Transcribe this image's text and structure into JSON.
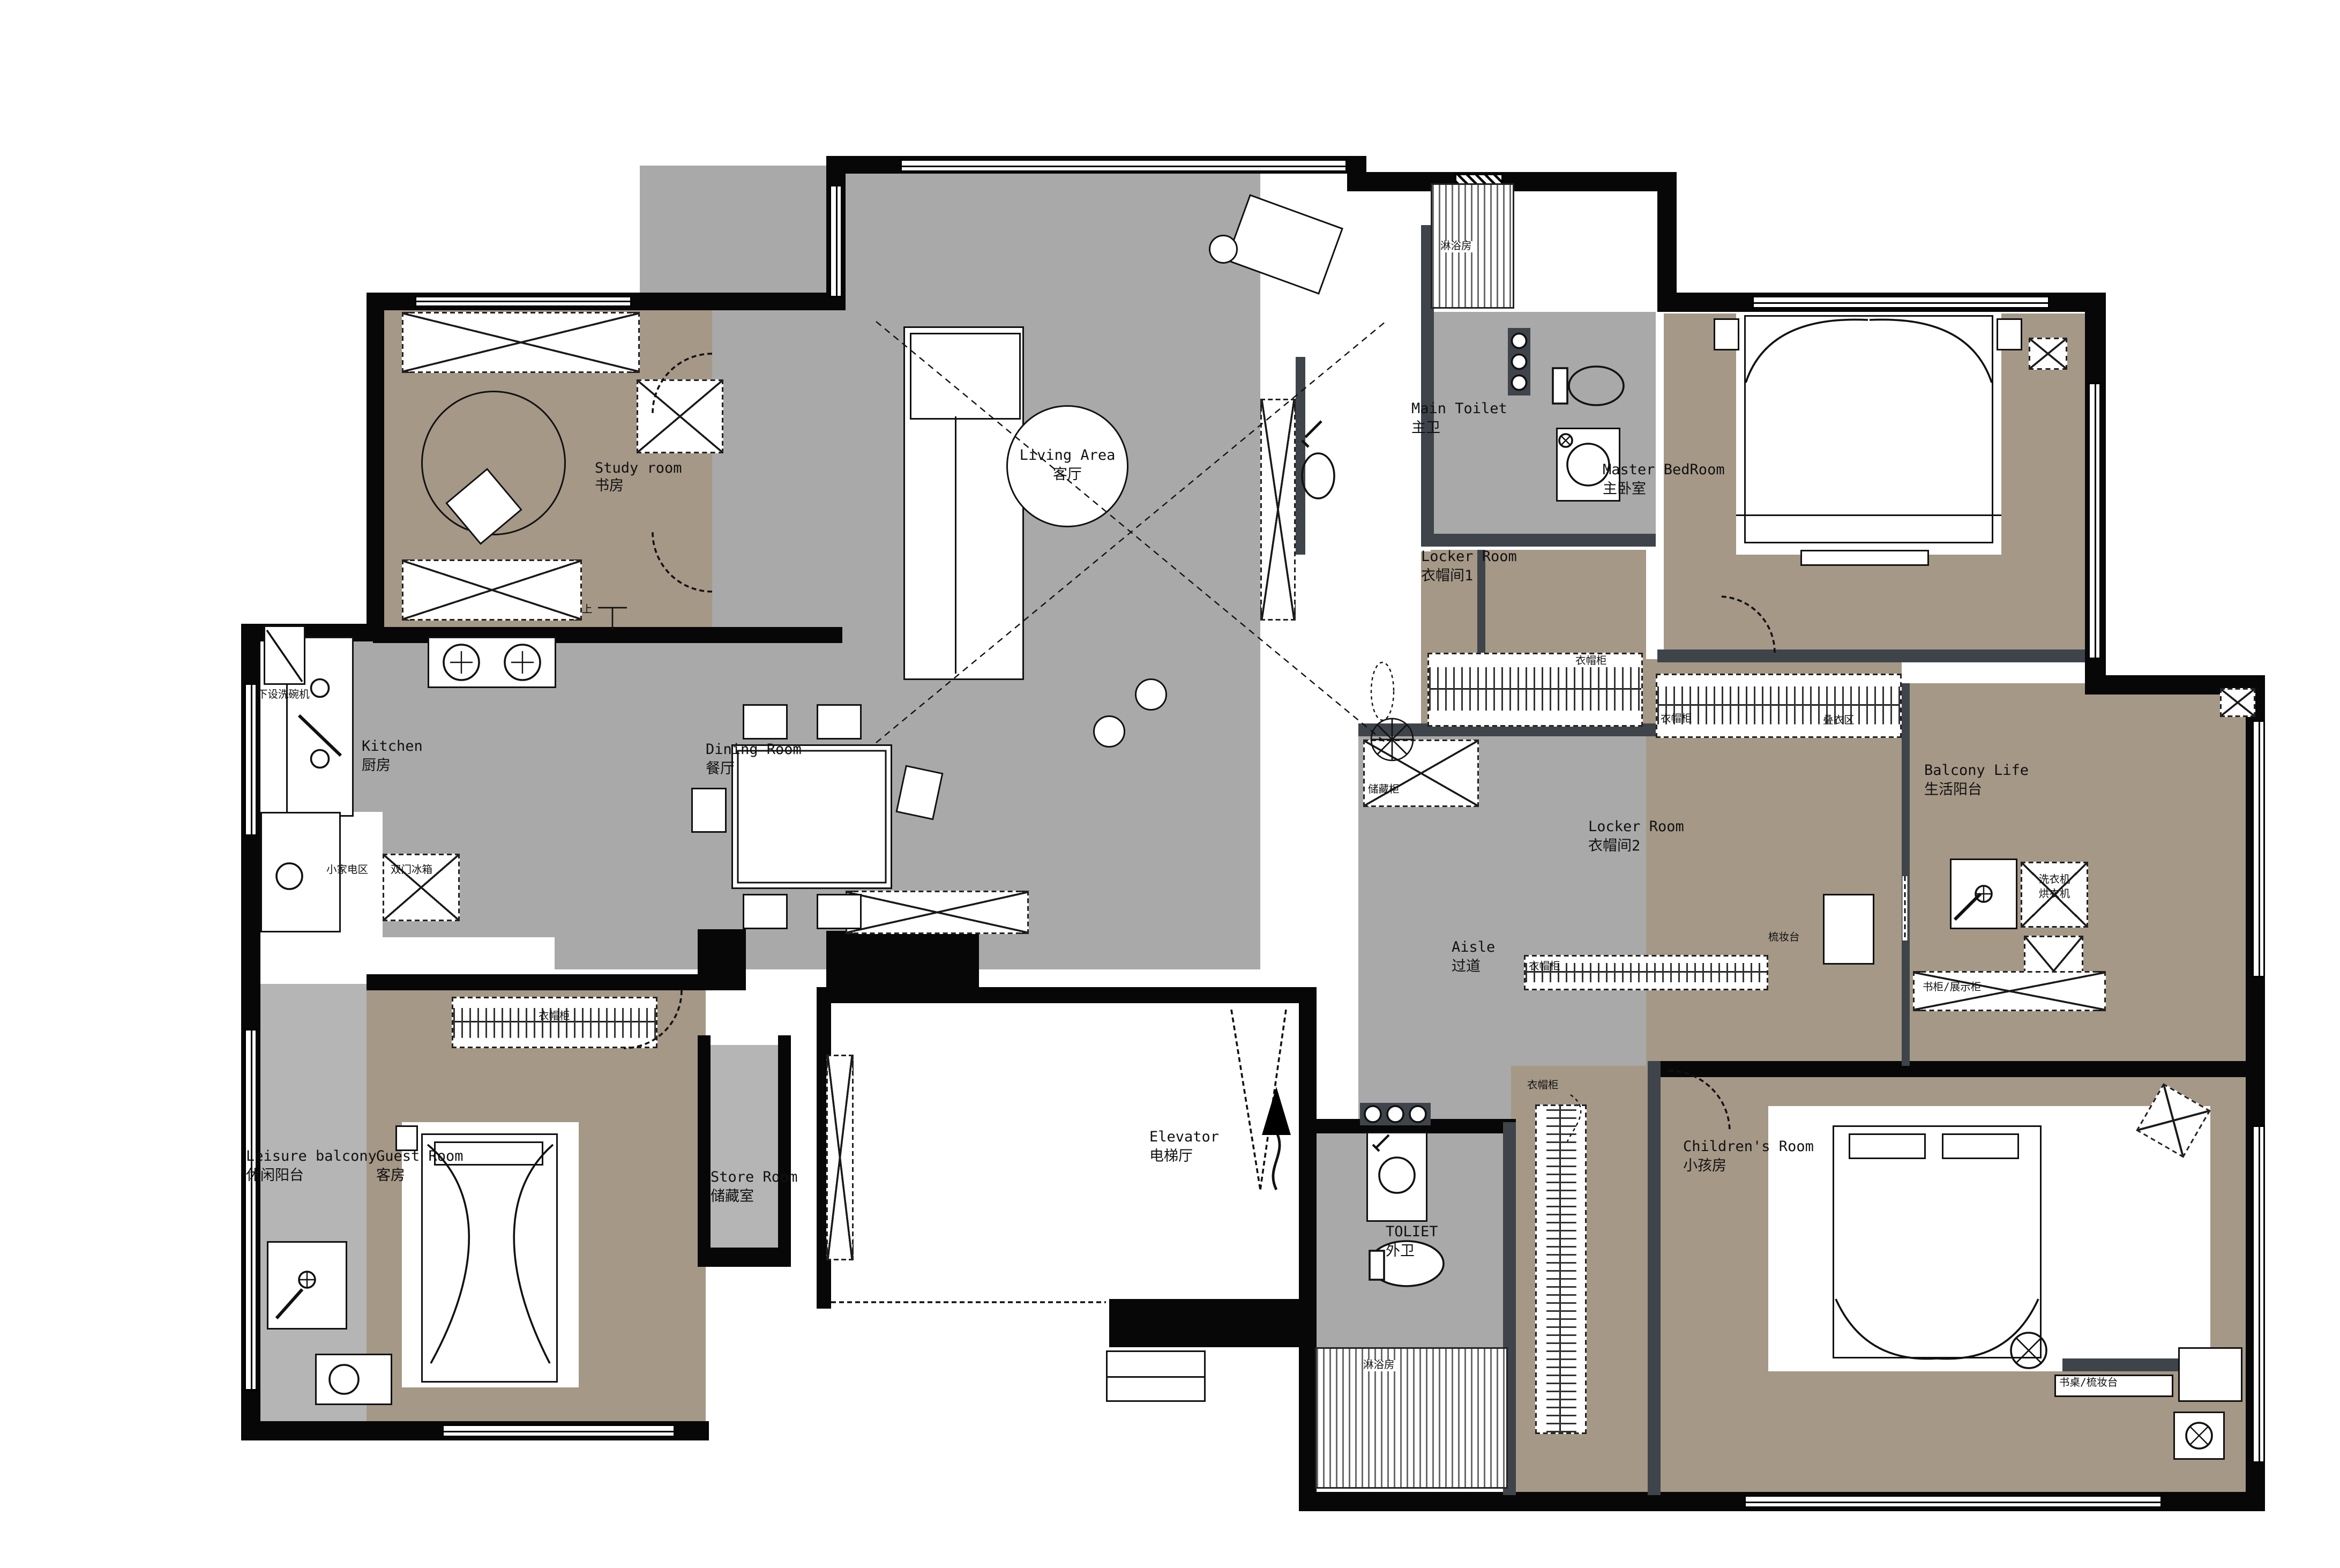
{
  "plan": {
    "rooms": {
      "study": {
        "en": "Study room",
        "zh": "书房"
      },
      "living": {
        "en": "Living Area",
        "zh": "客厅"
      },
      "dining": {
        "en": "Dining Room",
        "zh": "餐厅"
      },
      "kitchen": {
        "en": "Kitchen",
        "zh": "厨房"
      },
      "main_toilet": {
        "en": "Main Toilet",
        "zh": "主卫"
      },
      "master_bedroom": {
        "en": "Master BedRoom",
        "zh": "主卧室"
      },
      "locker1": {
        "en": "Locker Room",
        "zh": "衣帽间1"
      },
      "locker2": {
        "en": "Locker Room",
        "zh": "衣帽间2"
      },
      "balcony_life": {
        "en": "Balcony Life",
        "zh": "生活阳台"
      },
      "aisle": {
        "en": "Aisle",
        "zh": "过道"
      },
      "elevator": {
        "en": "Elevator",
        "zh": "电梯厅"
      },
      "outer_toilet": {
        "en": "TOLIET",
        "zh": "外卫"
      },
      "children": {
        "en": "Children's Room",
        "zh": "小孩房"
      },
      "guest": {
        "en": "Guest Room",
        "zh": "客房"
      },
      "leisure_balcony": {
        "en": "Leisure balcony",
        "zh": "休闲阳台"
      },
      "store": {
        "en": "Store Room",
        "zh": "储藏室"
      }
    },
    "annotations": {
      "dishwasher": "下设洗碗机",
      "small_appliances": "小家电区",
      "fridge": "双门冰箱",
      "shower_main": "淋浴房",
      "shower_outer": "淋浴房",
      "wardrobe": "衣帽柜",
      "folding_area": "叠衣区",
      "storage_cabinet": "储藏柜",
      "dressing_table": "梳妆台",
      "washer": "洗衣机",
      "dryer": "烘衣机",
      "bookcase_display": "书柜/展示柜",
      "desk_dressing": "书桌/梳妆台",
      "up": "上"
    },
    "colors": {
      "floor_public": "#a9a9a9",
      "floor_private": "#a59887",
      "floor_balcony": "#b5b5b5",
      "wall": "#070707",
      "wall_interior": "#3e444a"
    }
  }
}
